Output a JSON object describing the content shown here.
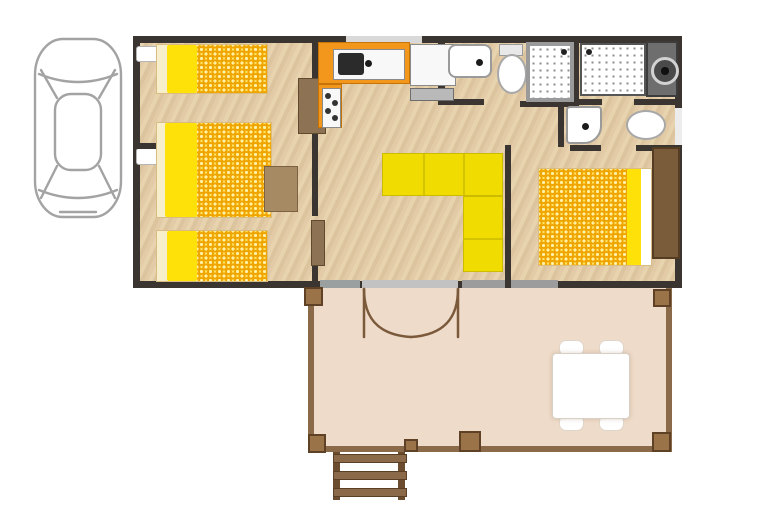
{
  "scene": {
    "kind": "floor-plan",
    "subject": "mobile-home plan: car parking space, three sleeping areas with yellow bedding, kitchen with orange counter, shower rooms, WC, yellow L-shaped lounge sofa, and covered terrace with dining set and access ladder"
  },
  "inventory": {
    "cars": 1,
    "single_beds": 2,
    "double_beds": 2,
    "kitchen_sinks": 1,
    "stove_burners": 4,
    "washbasins": 3,
    "toilets": 2,
    "showers": 2,
    "sofas": 1,
    "dining_tables": 1,
    "dining_chairs": 4,
    "terrace_posts": 6,
    "ladder_rungs": 3,
    "french_door_leaves": 2
  },
  "colors": {
    "wall": "#3a3531",
    "floor_wood": "#dcc49e",
    "bed_yellow": "#ffe10a",
    "duvet_bg": "#ffe564",
    "duvet_ring": "#f0a400",
    "kitchen_orange": "#f2971b",
    "sofa_yellow": "#f0dc00",
    "terrace_floor": "#efdbc9",
    "terrace_beam": "#8a6a48",
    "post_brown": "#9a7448",
    "ladder_brown": "#6b4c2e",
    "door_arc_brown": "#7a5a3b",
    "wardrobe_brown": "#7a5b3a",
    "furniture_tan": "#a58a64",
    "fixture_gray": "#9a9a9a",
    "counter_dark": "#6e6e6e",
    "appliance_gray": "#b9b9b9",
    "car_outline": "#a3a3a3",
    "window_light": "#d9d9d9"
  }
}
